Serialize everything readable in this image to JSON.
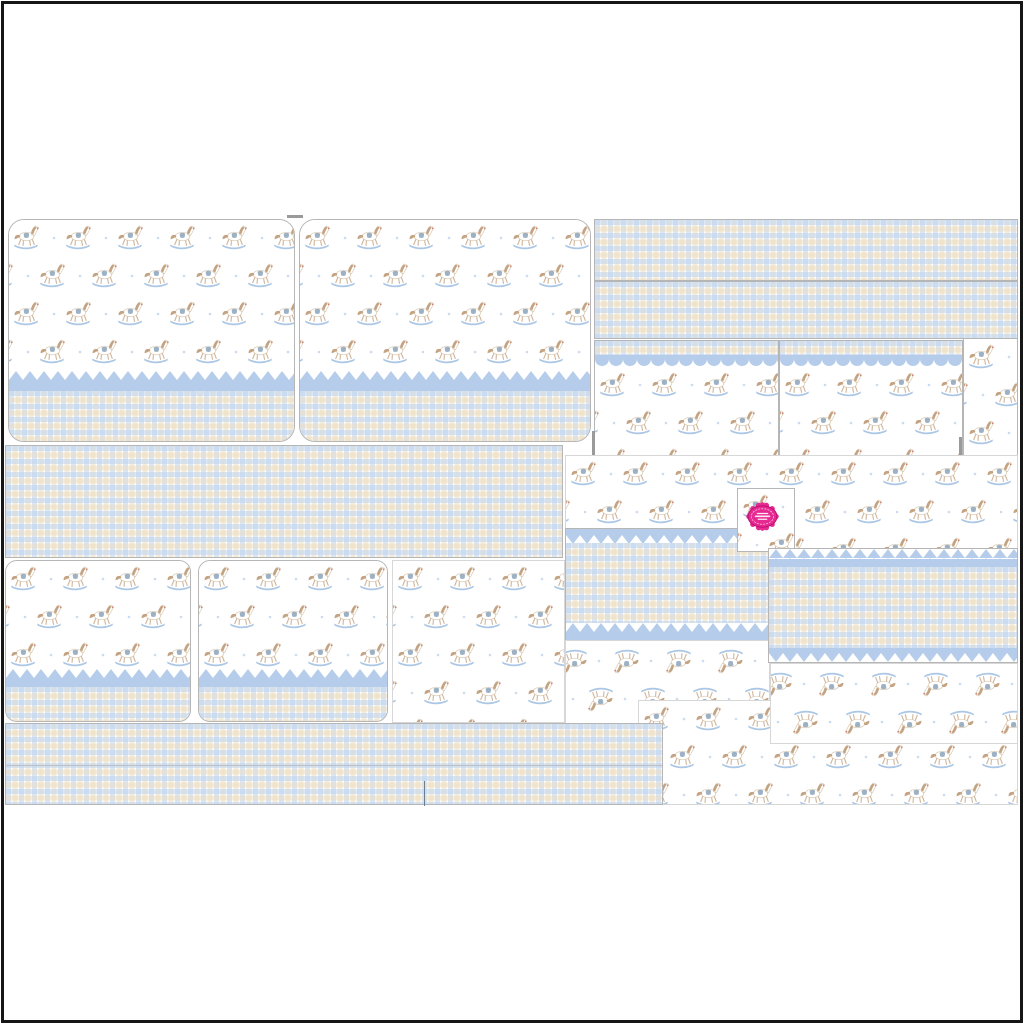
{
  "sheet": {
    "kind": "party-printables-template-collage",
    "theme": "baby-blue-rocking-horse",
    "patterns": [
      "rocking-horse-repeat",
      "blue-tan-gingham-check",
      "blue-bunting-scallop-border"
    ],
    "pieces": [
      {
        "name": "wrapper-card-top-left",
        "pattern": "horses+bunting+gingham"
      },
      {
        "name": "wrapper-card-top-center",
        "pattern": "horses+bunting+gingham"
      },
      {
        "name": "gingham-strip-right-upper",
        "pattern": "gingham"
      },
      {
        "name": "gingham-strip-right-lower",
        "pattern": "gingham"
      },
      {
        "name": "header-card-right-1",
        "pattern": "gingham+scallop+horses"
      },
      {
        "name": "header-card-right-2",
        "pattern": "gingham+scallop+horses"
      },
      {
        "name": "horse-strip-far-right",
        "pattern": "horses"
      },
      {
        "name": "gingham-band-middle-left",
        "pattern": "gingham"
      },
      {
        "name": "horse-field-middle-right",
        "pattern": "horses"
      },
      {
        "name": "brand-seal-square",
        "pattern": "horses"
      },
      {
        "name": "candy-wrapper-middle",
        "pattern": "bunting+gingham+bunting"
      },
      {
        "name": "inverted-horse-band-middle",
        "pattern": "horses-inverted"
      },
      {
        "name": "horse-field-bottom-right",
        "pattern": "horses"
      },
      {
        "name": "inverted-horse-field-right",
        "pattern": "horses-inverted"
      },
      {
        "name": "candy-wrapper-right",
        "pattern": "bunting+gingham+bunting"
      },
      {
        "name": "horse-field-bottom-left",
        "pattern": "horses"
      },
      {
        "name": "wrapper-card-bottom-left-1",
        "pattern": "horses+bunting+gingham"
      },
      {
        "name": "wrapper-card-bottom-left-2",
        "pattern": "horses+bunting+gingham"
      },
      {
        "name": "gingham-strip-bottom",
        "pattern": "gingham"
      }
    ]
  },
  "palette": {
    "paper_white": "#ffffff",
    "frame_black": "#161616",
    "gingham_blue": "#bdd3ec",
    "gingham_tan": "#e9dabb",
    "bunting_blue": "#b5cdea",
    "rocker_blue": "#abc7e5",
    "mane_tan": "#c4a382",
    "saddle_blue": "#9db1c5",
    "dot_blue": "#ccdcee",
    "horse_outline": "#d9c8b0",
    "muzzle_red": "#c98273",
    "badge_pink": "#e72a92",
    "badge_pink_dark": "#b80e70",
    "line_grey": "#b6b6b6"
  },
  "badge": {
    "color": "#e72a92",
    "outline": "#b80e70",
    "text_lines": 3
  }
}
